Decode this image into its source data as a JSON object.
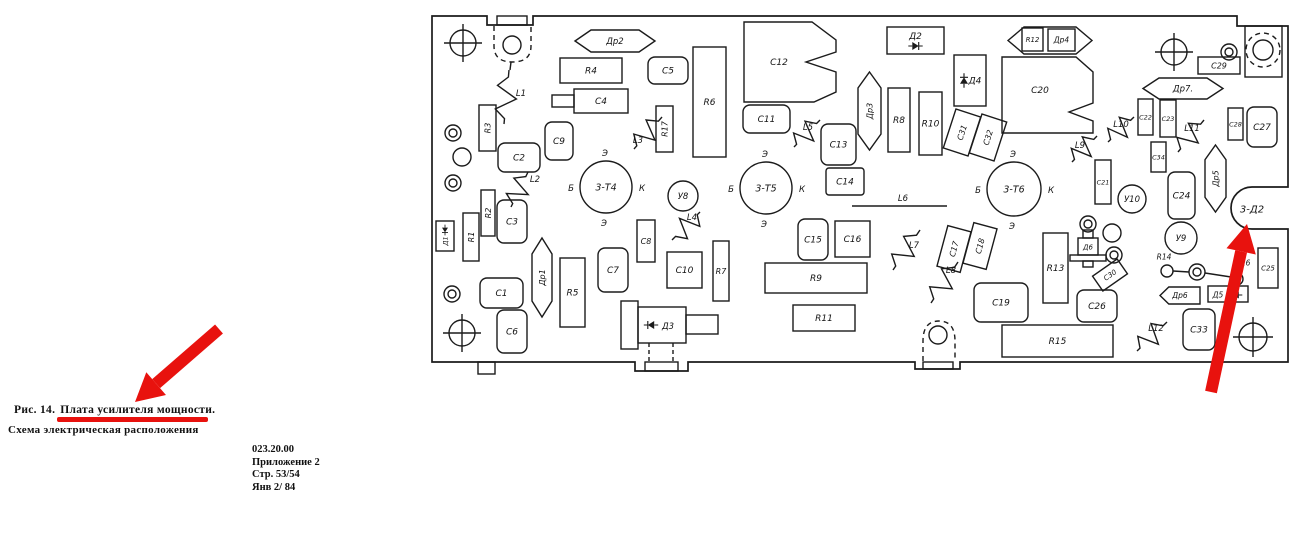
{
  "document": {
    "caption_prefix": "Рис. 14.",
    "caption_underlined": "Плата усилителя мощности.",
    "caption_line2": "Схема электрическая расположения",
    "reference_block": [
      "023.20.00",
      "Приложение 2",
      "Стр. 53/54",
      "Янв 2/ 84"
    ]
  },
  "colors": {
    "ink": "#1b1b1b",
    "paper": "#ffffff",
    "annotation_red": "#e8120e"
  },
  "board": {
    "cutout_label": "3-Д2",
    "parts": [
      {
        "k": "rect",
        "x": 560,
        "y": 58,
        "w": 62,
        "h": 25,
        "label": "R4"
      },
      {
        "k": "rect",
        "x": 574,
        "y": 89,
        "w": 54,
        "h": 24,
        "label": "C4",
        "tab": [
          552,
          95,
          22,
          12
        ]
      },
      {
        "k": "rect",
        "x": 693,
        "y": 47,
        "w": 33,
        "h": 110,
        "label": "R6"
      },
      {
        "k": "rect",
        "x": 479,
        "y": 105,
        "w": 17,
        "h": 46,
        "label": "R3",
        "lr": -90,
        "fs": 8
      },
      {
        "k": "rect",
        "x": 656,
        "y": 106,
        "w": 17,
        "h": 46,
        "label": "R17",
        "lr": -90,
        "fs": 8
      },
      {
        "k": "rect",
        "x": 463,
        "y": 213,
        "w": 16,
        "h": 48,
        "label": "R1",
        "lr": -90,
        "fs": 8
      },
      {
        "k": "rect",
        "x": 481,
        "y": 190,
        "w": 14,
        "h": 46,
        "label": "R2",
        "lr": -90,
        "fs": 8
      },
      {
        "k": "rect",
        "x": 560,
        "y": 258,
        "w": 25,
        "h": 69,
        "label": "R5"
      },
      {
        "k": "rect",
        "x": 637,
        "y": 220,
        "w": 18,
        "h": 42,
        "label": "C8",
        "fs": 8
      },
      {
        "k": "rect",
        "x": 667,
        "y": 252,
        "w": 35,
        "h": 36,
        "label": "C10"
      },
      {
        "k": "rect",
        "x": 713,
        "y": 241,
        "w": 16,
        "h": 60,
        "label": "R7",
        "fs": 8
      },
      {
        "k": "rect",
        "x": 888,
        "y": 88,
        "w": 22,
        "h": 64,
        "label": "R8"
      },
      {
        "k": "rect",
        "x": 919,
        "y": 92,
        "w": 23,
        "h": 63,
        "label": "R10"
      },
      {
        "k": "rect",
        "x": 949,
        "y": 112,
        "w": 26,
        "h": 41,
        "label": "C31",
        "tilt": 18,
        "lr": -90,
        "fs": 8
      },
      {
        "k": "rect",
        "x": 975,
        "y": 117,
        "w": 26,
        "h": 41,
        "label": "C32",
        "tilt": 18,
        "lr": -90,
        "fs": 8
      },
      {
        "k": "rect",
        "x": 826,
        "y": 168,
        "w": 38,
        "h": 27,
        "label": "C14",
        "rx": 3
      },
      {
        "k": "rect",
        "x": 835,
        "y": 221,
        "w": 35,
        "h": 36,
        "label": "C16"
      },
      {
        "k": "rect",
        "x": 765,
        "y": 263,
        "w": 102,
        "h": 30,
        "label": "R9"
      },
      {
        "k": "rect",
        "x": 793,
        "y": 305,
        "w": 62,
        "h": 26,
        "label": "R11"
      },
      {
        "k": "rect",
        "x": 942,
        "y": 228,
        "w": 24,
        "h": 42,
        "label": "C17",
        "tilt": 15,
        "lr": -90,
        "fs": 8
      },
      {
        "k": "rect",
        "x": 968,
        "y": 225,
        "w": 24,
        "h": 42,
        "label": "C18",
        "tilt": 15,
        "lr": -90,
        "fs": 8
      },
      {
        "k": "rect",
        "x": 1198,
        "y": 57,
        "w": 42,
        "h": 17,
        "label": "C29",
        "fs": 8
      },
      {
        "k": "rect",
        "x": 1138,
        "y": 99,
        "w": 15,
        "h": 36,
        "label": "C22",
        "fs": 6.5
      },
      {
        "k": "rect",
        "x": 1160,
        "y": 100,
        "w": 16,
        "h": 37,
        "label": "C23",
        "fs": 6.5
      },
      {
        "k": "rect",
        "x": 1228,
        "y": 108,
        "w": 15,
        "h": 32,
        "label": "C28",
        "fs": 6.5
      },
      {
        "k": "rect",
        "x": 1151,
        "y": 142,
        "w": 15,
        "h": 30,
        "label": "C34",
        "fs": 6.5
      },
      {
        "k": "rect",
        "x": 1095,
        "y": 160,
        "w": 16,
        "h": 44,
        "label": "C21",
        "fs": 6.5
      },
      {
        "k": "rect",
        "x": 1043,
        "y": 233,
        "w": 25,
        "h": 70,
        "label": "R13"
      },
      {
        "k": "rect",
        "x": 1258,
        "y": 248,
        "w": 20,
        "h": 40,
        "label": "C25",
        "fs": 7
      },
      {
        "k": "rect",
        "x": 1095,
        "y": 266,
        "w": 30,
        "h": 18,
        "label": "C30",
        "tilt": -35,
        "fs": 7
      },
      {
        "k": "rect",
        "x": 1002,
        "y": 325,
        "w": 111,
        "h": 32,
        "label": "R15"
      },
      {
        "k": "rect",
        "x": 1022,
        "y": 28,
        "w": 21,
        "h": 23,
        "label": "R12",
        "fs": 7
      },
      {
        "k": "rect",
        "x": 1048,
        "y": 29,
        "w": 27,
        "h": 22,
        "label": "Др4",
        "fs": 7.5
      },
      {
        "k": "poly",
        "d": "M744,22 H812 L836,40 V52 L806,62 L836,72 V92 L814,102 H744 Z",
        "label": "C12",
        "lx": 779,
        "ly": 62
      },
      {
        "k": "poly",
        "d": "M1002,57 H1076 L1093,72 V103 L1069,112 L1093,121 V133 H1002 Z",
        "label": "C20",
        "lx": 1040,
        "ly": 90
      },
      {
        "k": "rrect",
        "x": 648,
        "y": 57,
        "w": 40,
        "h": 27,
        "label": "C5"
      },
      {
        "k": "rrect",
        "x": 545,
        "y": 122,
        "w": 28,
        "h": 38,
        "label": "C9"
      },
      {
        "k": "rrect",
        "x": 498,
        "y": 143,
        "w": 42,
        "h": 29,
        "label": "C2"
      },
      {
        "k": "rrect",
        "x": 497,
        "y": 200,
        "w": 30,
        "h": 43,
        "label": "C3"
      },
      {
        "k": "rrect",
        "x": 480,
        "y": 278,
        "w": 43,
        "h": 30,
        "label": "C1"
      },
      {
        "k": "rrect",
        "x": 497,
        "y": 310,
        "w": 30,
        "h": 43,
        "label": "C6"
      },
      {
        "k": "rrect",
        "x": 598,
        "y": 248,
        "w": 30,
        "h": 44,
        "label": "C7"
      },
      {
        "k": "rrect",
        "x": 743,
        "y": 105,
        "w": 47,
        "h": 28,
        "label": "C11"
      },
      {
        "k": "rrect",
        "x": 821,
        "y": 124,
        "w": 35,
        "h": 41,
        "label": "C13"
      },
      {
        "k": "rrect",
        "x": 798,
        "y": 219,
        "w": 30,
        "h": 41,
        "label": "C15"
      },
      {
        "k": "rrect",
        "x": 974,
        "y": 283,
        "w": 54,
        "h": 39,
        "label": "C19"
      },
      {
        "k": "rrect",
        "x": 1168,
        "y": 172,
        "w": 27,
        "h": 47,
        "label": "C24"
      },
      {
        "k": "rrect",
        "x": 1077,
        "y": 290,
        "w": 40,
        "h": 32,
        "label": "C26"
      },
      {
        "k": "rrect",
        "x": 1247,
        "y": 107,
        "w": 30,
        "h": 40,
        "label": "C27"
      },
      {
        "k": "rrect",
        "x": 1183,
        "y": 309,
        "w": 32,
        "h": 41,
        "label": "C33"
      },
      {
        "k": "choke",
        "x": 575,
        "y": 30,
        "w": 80,
        "h": 22,
        "dir": "h",
        "label": "Др2"
      },
      {
        "k": "choke",
        "x": 1143,
        "y": 78,
        "w": 80,
        "h": 21,
        "dir": "h",
        "label": "Др7."
      },
      {
        "k": "choke",
        "x": 1008,
        "y": 27,
        "w": 84,
        "h": 27,
        "dir": "h",
        "label": "",
        "name": "choke-shell-R12-Dr4"
      },
      {
        "k": "choke",
        "x": 1160,
        "y": 287,
        "w": 40,
        "h": 17,
        "dir": "h",
        "flat": "right",
        "label": "Др6",
        "fs": 7.5
      },
      {
        "k": "choke",
        "x": 532,
        "y": 238,
        "w": 20,
        "h": 79,
        "dir": "v",
        "label": "Др1",
        "fs": 8
      },
      {
        "k": "choke",
        "x": 858,
        "y": 72,
        "w": 23,
        "h": 78,
        "dir": "v",
        "label": "Др3",
        "fs": 8
      },
      {
        "k": "choke",
        "x": 1205,
        "y": 145,
        "w": 21,
        "h": 67,
        "dir": "v",
        "label": "Др5",
        "fs": 8
      },
      {
        "k": "coil",
        "x1": 509,
        "y1": 70,
        "x2": 504,
        "y2": 124,
        "label": "L1",
        "lx": 521,
        "ly": 93
      },
      {
        "k": "coil",
        "x1": 528,
        "y1": 172,
        "x2": 511,
        "y2": 207,
        "label": "L2",
        "lx": 535,
        "ly": 179
      },
      {
        "k": "coil",
        "x1": 662,
        "y1": 117,
        "x2": 634,
        "y2": 149,
        "label": "L3",
        "lx": 638,
        "ly": 140
      },
      {
        "k": "coil",
        "x1": 672,
        "y1": 240,
        "x2": 700,
        "y2": 212,
        "label": "L4",
        "lx": 692,
        "ly": 217
      },
      {
        "k": "coil",
        "x1": 820,
        "y1": 120,
        "x2": 794,
        "y2": 147,
        "label": "L5",
        "lx": 808,
        "ly": 127
      },
      {
        "k": "coil",
        "x1": 920,
        "y1": 230,
        "x2": 893,
        "y2": 270,
        "label": "L7",
        "lx": 914,
        "ly": 245
      },
      {
        "k": "coil",
        "x1": 958,
        "y1": 262,
        "x2": 931,
        "y2": 303,
        "label": "L8",
        "lx": 951,
        "ly": 270
      },
      {
        "k": "coil",
        "x1": 1097,
        "y1": 136,
        "x2": 1072,
        "y2": 162,
        "label": "L9",
        "lx": 1080,
        "ly": 145
      },
      {
        "k": "coil",
        "x1": 1134,
        "y1": 117,
        "x2": 1108,
        "y2": 142,
        "label": "L10",
        "lx": 1121,
        "ly": 124
      },
      {
        "k": "coil",
        "x1": 1204,
        "y1": 120,
        "x2": 1178,
        "y2": 152,
        "label": "L11",
        "lx": 1192,
        "ly": 128
      },
      {
        "k": "coil",
        "x1": 1167,
        "y1": 322,
        "x2": 1137,
        "y2": 351,
        "label": "L12",
        "lx": 1156,
        "ly": 328
      },
      {
        "k": "coilline",
        "x1": 852,
        "y1": 206,
        "x2": 947,
        "y2": 206,
        "label": "L6",
        "lx": 903,
        "ly": 198
      },
      {
        "k": "trans",
        "cx": 606,
        "cy": 187,
        "r": 26,
        "label": "3-Т4",
        "pins": {
          "top": "Э",
          "left": "Б",
          "right": "К",
          "bottom": "Э"
        }
      },
      {
        "k": "trans",
        "cx": 766,
        "cy": 188,
        "r": 26,
        "label": "3-Т5",
        "pins": {
          "top": "Э",
          "left": "Б",
          "right": "К",
          "bottom": "Э"
        }
      },
      {
        "k": "trans",
        "cx": 1014,
        "cy": 189,
        "r": 27,
        "label": "3-Т6",
        "pins": {
          "top": "Э",
          "left": "Б",
          "right": "К",
          "bottom": "Э"
        }
      },
      {
        "k": "mod",
        "cx": 683,
        "cy": 196,
        "r": 15,
        "label": "У8"
      },
      {
        "k": "mod",
        "cx": 1181,
        "cy": 238,
        "r": 16,
        "label": "У9"
      },
      {
        "k": "mod",
        "cx": 1132,
        "cy": 199,
        "r": 14,
        "label": "У10"
      },
      {
        "k": "diode",
        "kind": "v",
        "x": 436,
        "y": 221,
        "w": 18,
        "h": 30,
        "label": "Д1"
      },
      {
        "k": "diode",
        "kind": "h2",
        "x": 887,
        "y": 27,
        "w": 57,
        "h": 27,
        "label": "Д2"
      },
      {
        "k": "diode",
        "kind": "vz",
        "x": 954,
        "y": 55,
        "w": 32,
        "h": 51,
        "label": "Д4"
      },
      {
        "k": "diode",
        "kind": "hr",
        "x": 1208,
        "y": 286,
        "w": 40,
        "h": 16,
        "label": "Д5"
      },
      {
        "k": "d3",
        "label": "Д3"
      },
      {
        "k": "d6",
        "label": "Д6"
      },
      {
        "k": "link",
        "label1": "R14",
        "label2": "R16"
      },
      {
        "k": "cutlabel",
        "x": 1252,
        "y": 209,
        "label": "3-Д2"
      },
      {
        "k": "hole",
        "cx": 463,
        "cy": 43,
        "r": 13
      },
      {
        "k": "hole",
        "cx": 462,
        "cy": 333,
        "r": 13
      },
      {
        "k": "hole",
        "cx": 1174,
        "cy": 52,
        "r": 13
      },
      {
        "k": "hole",
        "cx": 1253,
        "cy": 337,
        "r": 14
      },
      {
        "k": "tp",
        "cx": 453,
        "cy": 133
      },
      {
        "k": "tp",
        "cx": 453,
        "cy": 183
      },
      {
        "k": "tp",
        "cx": 452,
        "cy": 294
      },
      {
        "k": "tp",
        "cx": 1229,
        "cy": 52
      },
      {
        "k": "tp",
        "cx": 1088,
        "cy": 224
      },
      {
        "k": "tp",
        "cx": 1114,
        "cy": 255
      },
      {
        "k": "tp",
        "cx": 1197,
        "cy": 272
      },
      {
        "k": "pad",
        "cx": 462,
        "cy": 157,
        "r": 9
      },
      {
        "k": "pad",
        "cx": 1112,
        "cy": 233,
        "r": 9
      }
    ],
    "annotations": {
      "arrow_caption": {
        "tail": [
          219,
          329
        ],
        "tip": [
          135,
          402
        ]
      },
      "arrow_board": {
        "tail": [
          1211,
          392
        ],
        "tip": [
          1247,
          224
        ]
      }
    }
  }
}
